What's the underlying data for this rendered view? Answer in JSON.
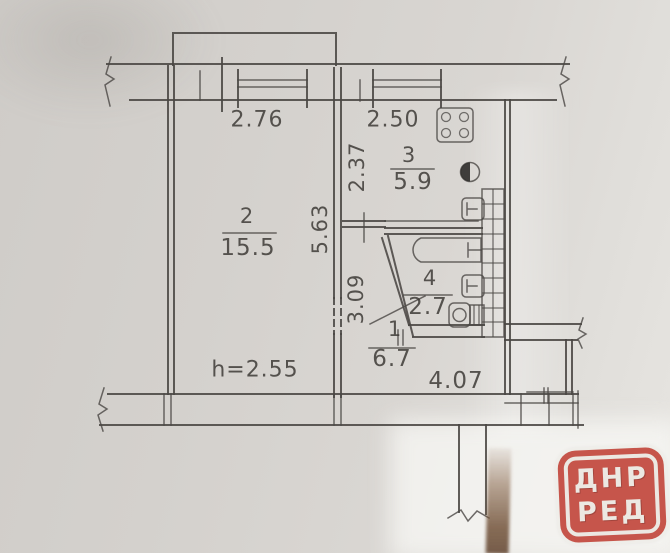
{
  "floorplan": {
    "rooms": [
      {
        "id": "room-2",
        "number": "2",
        "area": "15.5"
      },
      {
        "id": "room-3",
        "number": "3",
        "area": "5.9"
      },
      {
        "id": "room-4",
        "number": "4",
        "area": "2.7"
      },
      {
        "id": "room-1",
        "number": "1",
        "area": "6.7"
      }
    ],
    "dimensions": {
      "room2_top_width": "2.76",
      "kitchen_top_width": "2.50",
      "kitchen_side_depth": "2.37",
      "room2_side_depth": "5.63",
      "hall_side_depth": "3.09",
      "hall_bottom_width": "4.07",
      "ceiling_height": "h=2.55"
    },
    "colors": {
      "line": "#4a4744",
      "paper": "#d6d3cf",
      "stamp_red": "#c6554b",
      "stamp_text": "#ece8e2"
    }
  },
  "watermark": {
    "line1": "ДНР",
    "line2": "РЕД"
  }
}
